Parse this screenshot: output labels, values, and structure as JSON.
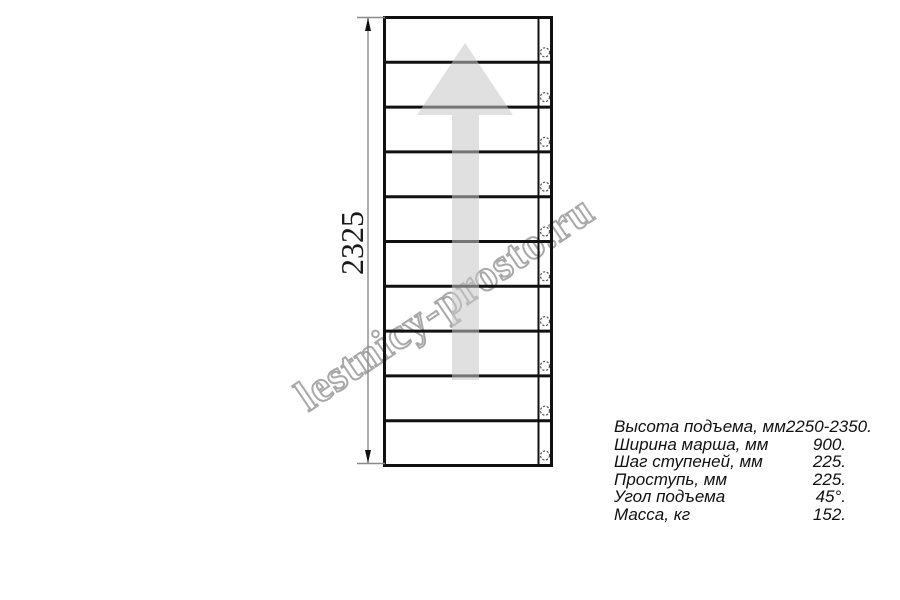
{
  "watermark": {
    "text": "lestnicy-prosto.ru",
    "outline_color": "#a8a8a8"
  },
  "drawing": {
    "dimension_label": "2325",
    "step_count": 10,
    "line_color": "#111111",
    "dim_line_color": "#8a8a8a",
    "circle_color": "#555555",
    "arrow_fill": "#c6c6c6",
    "arrow_opacity": 0.55
  },
  "specs": {
    "rows": [
      {
        "label": "Высота подъема, мм",
        "value": "2250-2350."
      },
      {
        "label": "Ширина марша, мм",
        "value": "900."
      },
      {
        "label": "Шаг ступеней, мм",
        "value": "225."
      },
      {
        "label": "Проступь, мм",
        "value": "225."
      },
      {
        "label": "Угол подъема",
        "value": "45°."
      },
      {
        "label": "Масса, кг",
        "value": "152."
      }
    ]
  }
}
